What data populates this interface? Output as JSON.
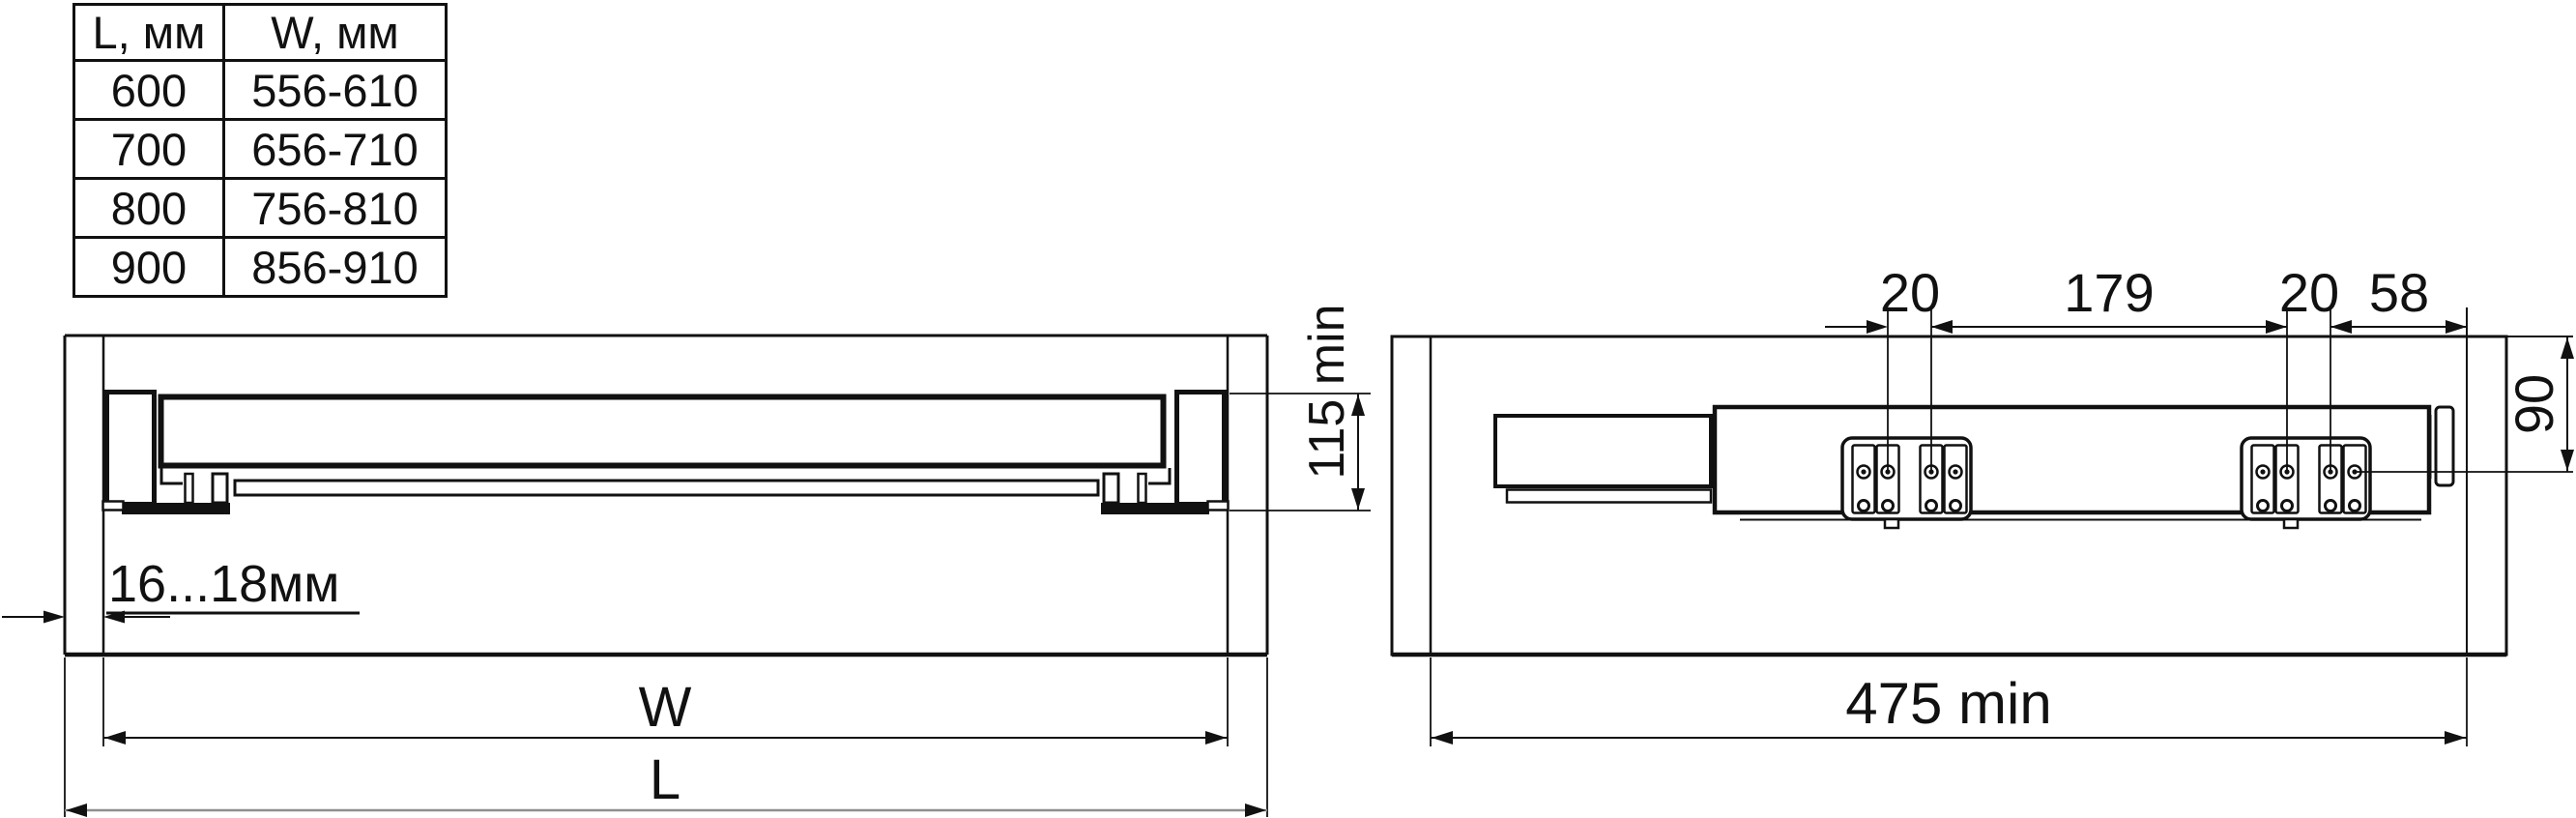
{
  "size_table": {
    "columns": [
      "L, мм",
      "W, мм"
    ],
    "rows": [
      {
        "l": "600",
        "w": "556-610"
      },
      {
        "l": "700",
        "w": "656-710"
      },
      {
        "l": "800",
        "w": "756-810"
      },
      {
        "l": "900",
        "w": "856-910"
      }
    ]
  },
  "front_view": {
    "dim_panel_thickness": "16...18мм",
    "dim_height": "115 min",
    "dim_inner_width": "W",
    "dim_outer_width": "L"
  },
  "side_view": {
    "dim_hole_offset_left": "20",
    "dim_hole_spacing": "179",
    "dim_hole_offset_right": "20",
    "dim_front_offset": "58",
    "dim_height": "90",
    "dim_depth": "475 min"
  },
  "colors": {
    "line": "#111111",
    "dim_gray": "#8f8f8f",
    "background": "#ffffff"
  }
}
